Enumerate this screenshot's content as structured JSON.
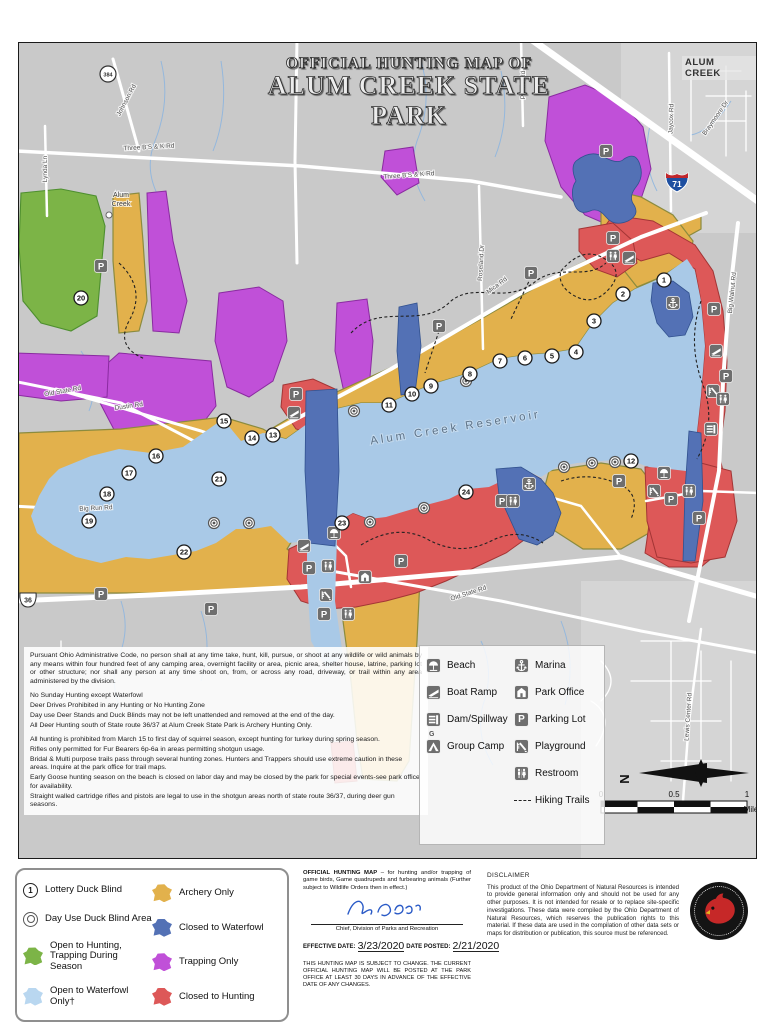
{
  "colors": {
    "land": "#c9c9c9",
    "land_light": "#d5d5d5",
    "water": "#a9c9e7",
    "road": "#ffffff",
    "stream": "#8fb6df",
    "archery_gold": "#e2b14c",
    "trapping_purple": "#c050d8",
    "closed_hunting_red": "#dd5858",
    "closed_waterfowl_blue": "#5371b5",
    "open_hunting_green": "#7cb447",
    "open_waterfowl_blue": "#b9d7f0",
    "icon_gray": "#6e6e6e",
    "signature_blue": "#2b5bc7"
  },
  "map": {
    "title_line1": "OFFICIAL HUNTING MAP OF",
    "title_line2": "ALUM CREEK STATE PARK",
    "corner_label": "ALUM CREEK",
    "water_label": "Alum Creek Reservoir",
    "town_label": [
      "Alum",
      "Creek"
    ],
    "north_label": "N",
    "scale": {
      "ticks": [
        "0",
        "0.5",
        "1"
      ],
      "unit": "Miles"
    },
    "shields": {
      "interstate": "71",
      "state_circle": "384",
      "us_route": "36"
    },
    "road_labels": [
      {
        "t": "Johnson Rd",
        "x": 127,
        "y": 100,
        "r": -62
      },
      {
        "t": "Three B'S & K Rd",
        "x": 148,
        "y": 148,
        "r": -3
      },
      {
        "t": "Three B'S & K Rd",
        "x": 408,
        "y": 176,
        "r": -4
      },
      {
        "t": "Lynda Ln",
        "x": 46,
        "y": 168,
        "r": -90
      },
      {
        "t": "Jaycox Rd",
        "x": 672,
        "y": 118,
        "r": -88
      },
      {
        "t": "Plumb Rd",
        "x": 524,
        "y": 84,
        "r": -90
      },
      {
        "t": "Braymoore Dr",
        "x": 716,
        "y": 118,
        "r": -55
      },
      {
        "t": "Roseland Dr",
        "x": 482,
        "y": 262,
        "r": -87
      },
      {
        "t": "Mica Rd",
        "x": 497,
        "y": 286,
        "r": -37
      },
      {
        "t": "Old State Rd",
        "x": 62,
        "y": 392,
        "r": -10
      },
      {
        "t": "Dustin Rd",
        "x": 128,
        "y": 407,
        "r": -8
      },
      {
        "t": "Big Run Rd",
        "x": 95,
        "y": 509,
        "r": -3
      },
      {
        "t": "Old State Rd",
        "x": 468,
        "y": 594,
        "r": -18
      },
      {
        "t": "Big Walnut Rd",
        "x": 733,
        "y": 292,
        "r": -84
      },
      {
        "t": "Lewis Center Rd",
        "x": 689,
        "y": 716,
        "r": -86
      }
    ],
    "blinds": [
      {
        "n": "1",
        "x": 663,
        "y": 279
      },
      {
        "n": "2",
        "x": 622,
        "y": 293
      },
      {
        "n": "3",
        "x": 593,
        "y": 320
      },
      {
        "n": "4",
        "x": 575,
        "y": 351
      },
      {
        "n": "5",
        "x": 551,
        "y": 355
      },
      {
        "n": "6",
        "x": 524,
        "y": 357
      },
      {
        "n": "7",
        "x": 499,
        "y": 360
      },
      {
        "n": "8",
        "x": 469,
        "y": 373
      },
      {
        "n": "9",
        "x": 430,
        "y": 385
      },
      {
        "n": "10",
        "x": 411,
        "y": 393
      },
      {
        "n": "11",
        "x": 388,
        "y": 404
      },
      {
        "n": "12",
        "x": 630,
        "y": 460
      },
      {
        "n": "13",
        "x": 272,
        "y": 434
      },
      {
        "n": "14",
        "x": 251,
        "y": 437
      },
      {
        "n": "15",
        "x": 223,
        "y": 420
      },
      {
        "n": "16",
        "x": 155,
        "y": 455
      },
      {
        "n": "17",
        "x": 128,
        "y": 472
      },
      {
        "n": "18",
        "x": 106,
        "y": 493
      },
      {
        "n": "19",
        "x": 88,
        "y": 520
      },
      {
        "n": "20",
        "x": 80,
        "y": 297
      },
      {
        "n": "21",
        "x": 218,
        "y": 478
      },
      {
        "n": "22",
        "x": 183,
        "y": 551
      },
      {
        "n": "23",
        "x": 341,
        "y": 522
      },
      {
        "n": "24",
        "x": 465,
        "y": 491
      }
    ],
    "day_use_blinds": [
      [
        465,
        380
      ],
      [
        369,
        521
      ],
      [
        423,
        507
      ],
      [
        563,
        466
      ],
      [
        591,
        462
      ],
      [
        614,
        461
      ],
      [
        213,
        522
      ],
      [
        248,
        522
      ],
      [
        353,
        410
      ]
    ],
    "parking": [
      [
        100,
        265
      ],
      [
        295,
        393
      ],
      [
        438,
        325
      ],
      [
        530,
        272
      ],
      [
        605,
        150
      ],
      [
        612,
        237
      ],
      [
        713,
        308
      ],
      [
        725,
        375
      ],
      [
        618,
        480
      ],
      [
        670,
        498
      ],
      [
        698,
        517
      ],
      [
        501,
        500
      ],
      [
        308,
        567
      ],
      [
        400,
        560
      ],
      [
        323,
        613
      ],
      [
        100,
        593
      ],
      [
        210,
        608
      ]
    ],
    "facilities": [
      {
        "icon": "beach",
        "x": 333,
        "y": 532
      },
      {
        "icon": "beach",
        "x": 663,
        "y": 472
      },
      {
        "icon": "boat-ramp",
        "x": 303,
        "y": 545
      },
      {
        "icon": "boat-ramp",
        "x": 628,
        "y": 257
      },
      {
        "icon": "boat-ramp",
        "x": 293,
        "y": 412
      },
      {
        "icon": "boat-ramp",
        "x": 715,
        "y": 350
      },
      {
        "icon": "dam",
        "x": 710,
        "y": 428
      },
      {
        "icon": "marina",
        "x": 528,
        "y": 483
      },
      {
        "icon": "marina",
        "x": 672,
        "y": 302
      },
      {
        "icon": "office",
        "x": 364,
        "y": 576
      },
      {
        "icon": "playground",
        "x": 325,
        "y": 594
      },
      {
        "icon": "playground",
        "x": 653,
        "y": 490
      },
      {
        "icon": "playground",
        "x": 712,
        "y": 390
      },
      {
        "icon": "restroom",
        "x": 327,
        "y": 565
      },
      {
        "icon": "restroom",
        "x": 347,
        "y": 613
      },
      {
        "icon": "restroom",
        "x": 688,
        "y": 490
      },
      {
        "icon": "restroom",
        "x": 612,
        "y": 255
      },
      {
        "icon": "restroom",
        "x": 722,
        "y": 398
      },
      {
        "icon": "restroom",
        "x": 512,
        "y": 500
      }
    ]
  },
  "regulations": {
    "para1": "Pursuant Ohio Administrative Code, no  person shall at any time take, hunt, kill, pursue, or shoot at any wildlife or wild animals by any means within four hundred feet of any camping area, overnight facility or area, picnic area, shelter house, latrine, parking lot or other structure; nor shall any person at any time shoot on, from, or across any road, driveway, or trail within any area administered by the division.",
    "group1": [
      "No Sunday Hunting except Waterfowl",
      "Deer Drives Prohibited in any Hunting or No Hunting Zone",
      "Day use Deer Stands and Duck Blinds may not be left unattended and removed at the end of the day.",
      "All Deer Hunting south of State route 36/37 at Alum Creek State Park is Archery Hunting Only."
    ],
    "group2": [
      "All hunting is prohibited from March 15 to first day of squirrel season, except hunting for turkey during spring season.",
      "Rifles only permitted for Fur Bearers 6p-6a in areas permitting shotgun usage.",
      "Bridal & Multi purpose trails pass through several hunting zones. Hunters and Trappers should use extreme caution in these areas. Inquire at the park office for trail maps.",
      "Early Goose hunting season on the beach is closed on labor day and may be closed by the park for special events-see park office for availability.",
      "Straight walled cartridge rifles and pistols are legal to use in the shotgun areas north of state route 36/37, during deer gun seasons."
    ]
  },
  "map_legend": {
    "left": [
      {
        "icon": "beach",
        "label": "Beach"
      },
      {
        "icon": "boat-ramp",
        "label": "Boat Ramp"
      },
      {
        "icon": "dam",
        "label": "Dam/Spillway"
      },
      {
        "icon": "camp",
        "label": "Group Camp",
        "badge": "G"
      }
    ],
    "right": [
      {
        "icon": "marina",
        "label": "Marina"
      },
      {
        "icon": "office",
        "label": "Park Office"
      },
      {
        "icon": "parking",
        "label": "Parking Lot"
      },
      {
        "icon": "playground",
        "label": "Playground"
      },
      {
        "icon": "restroom",
        "label": "Restroom"
      },
      {
        "icon": "trail",
        "label": "Hiking Trails"
      }
    ]
  },
  "bottom_legend": {
    "left": [
      {
        "marker": "lottery",
        "num": "1",
        "label": "Lottery Duck Blind"
      },
      {
        "marker": "dayuse",
        "label": "Day Use Duck Blind Area"
      },
      {
        "marker": "patch",
        "color": "open_hunting_green",
        "label": "Open to Hunting, Trapping During Season"
      },
      {
        "marker": "patch",
        "color": "open_waterfowl_blue",
        "label": "Open to Waterfowl Only†"
      }
    ],
    "right": [
      {
        "marker": "patch",
        "color": "archery_gold",
        "label": "Archery Only"
      },
      {
        "marker": "patch",
        "color": "closed_waterfowl_blue",
        "label": "Closed to Waterfowl"
      },
      {
        "marker": "patch",
        "color": "trapping_purple",
        "label": "Trapping Only"
      },
      {
        "marker": "patch",
        "color": "closed_hunting_red",
        "label": "Closed to Hunting"
      }
    ]
  },
  "filing": {
    "intro_bold": "OFFICIAL HUNTING MAP",
    "intro_rest": " – for hunting and/or trapping of game birds, Game quadrupeds and furbearing animals (Further subject to Wildlife Orders then in effect.)",
    "signature_title": "Chief, Division of Parks and Recreation",
    "effective_label": "EFFECTIVE DATE:",
    "effective_value": "3/23/2020",
    "posted_label": "DATE POSTED:",
    "posted_value": "2/21/2020",
    "note": "THIS HUNTING MAP IS SUBJECT TO CHANGE. THE CURRENT OFFICIAL HUNTING MAP WILL BE POSTED AT THE PARK OFFICE AT LEAST 30 DAYS IN ADVANCE OF THE EFFECTIVE DATE OF ANY CHANGES."
  },
  "disclaimer": {
    "title": "DISCLAIMER",
    "text": "This product of the Ohio Department of Natural Resources is intended to provide general information only and should not be used for any other purposes. It is not intended for resale or to replace site-specific investigations. These data were compiled by the Ohio Department of Natural Resources, which reserves the publication rights to this material. If these data are used in the compilation of other data sets or maps for distribution or publication, this source must be referenced."
  }
}
